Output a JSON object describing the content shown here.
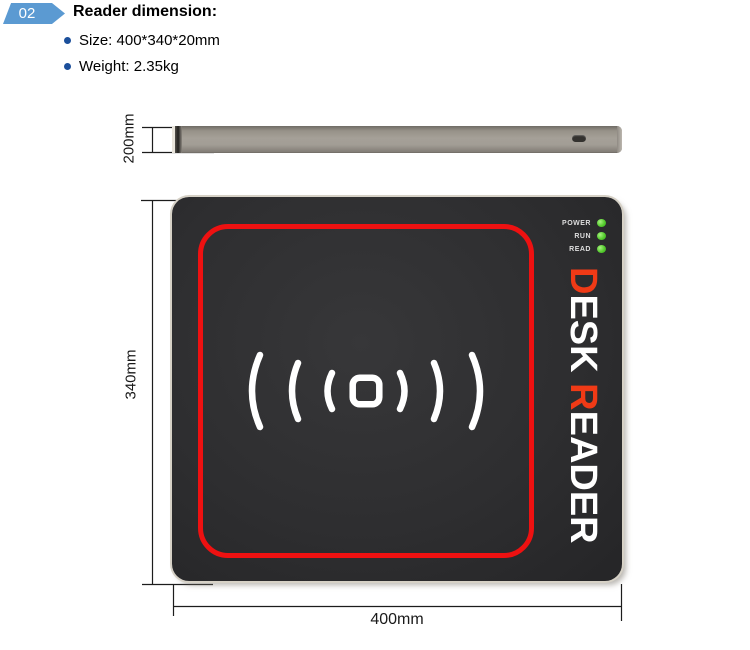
{
  "header": {
    "badge": "02",
    "title": "Reader dimension:",
    "bullets": [
      {
        "label": "Size: 400*340*20mm"
      },
      {
        "label": "Weight: 2.35kg"
      }
    ]
  },
  "side_view": {
    "dim_label": "200mm"
  },
  "front_view": {
    "dim_height": "340mm",
    "dim_width": "400mm",
    "leds": [
      {
        "label": "POWER"
      },
      {
        "label": "RUN"
      },
      {
        "label": "READ"
      }
    ],
    "brand": {
      "word1_first": "D",
      "word1_rest": "ESK ",
      "word2_first": "R",
      "word2_rest": "EADER"
    }
  },
  "colors": {
    "badge_blue": "#5b9ad2",
    "bullet_blue": "#1b4f9b",
    "frame_red": "#ee1111",
    "brand_red": "#f03a16",
    "led_green": "#44c427",
    "device_body": "#2e2e30",
    "side_metal": "#a19c94"
  }
}
